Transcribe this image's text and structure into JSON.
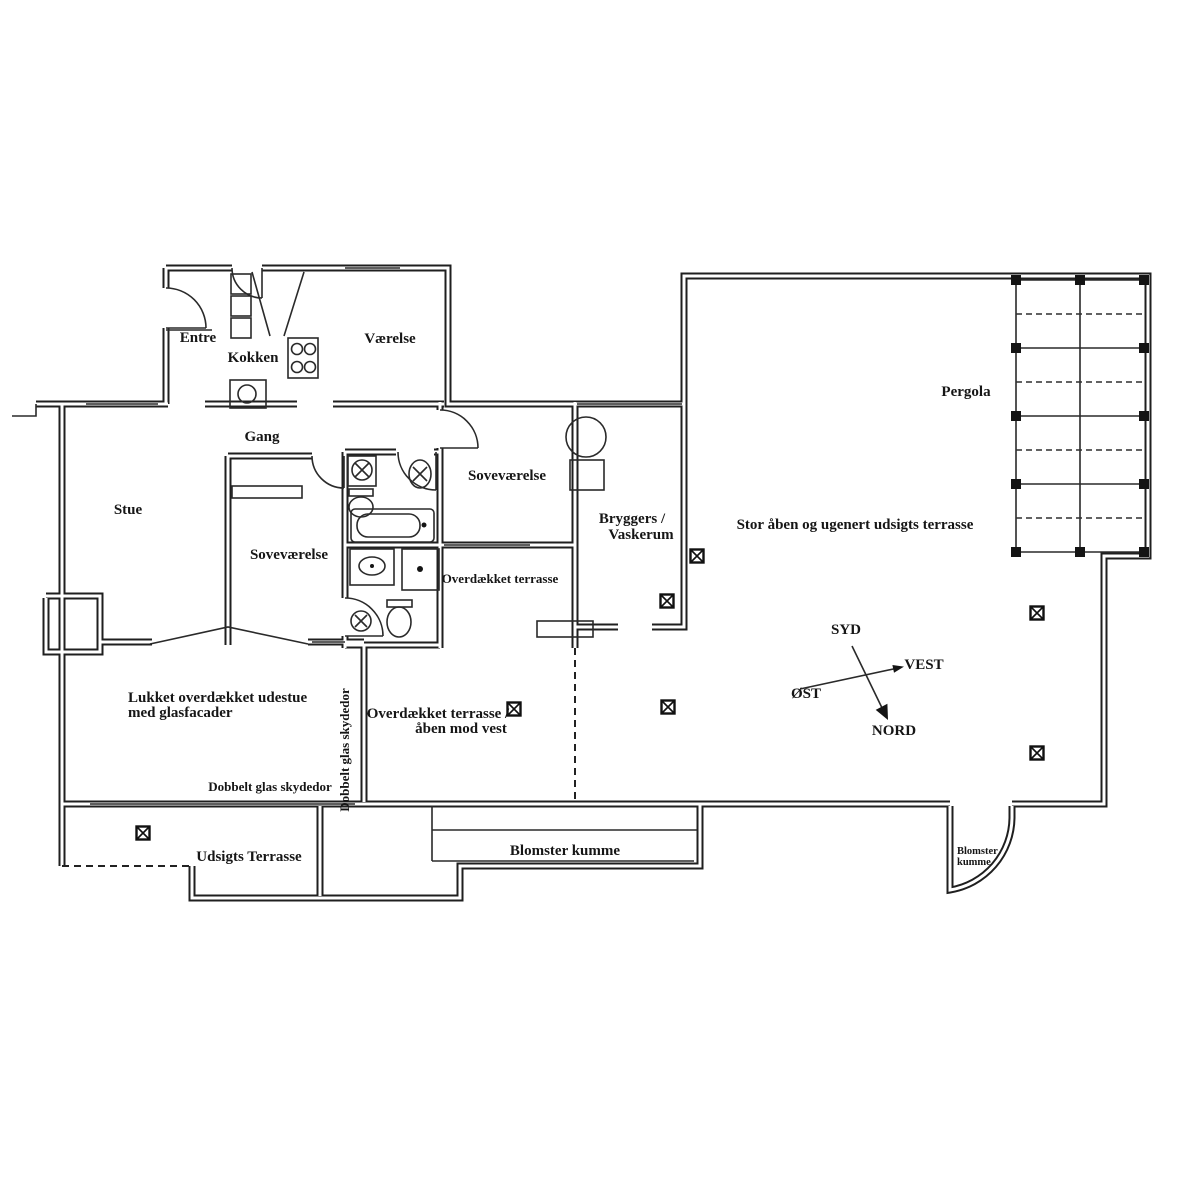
{
  "document": {
    "type": "floor-plan-drawing",
    "background_color": "#ffffff",
    "ink_color": "#1f1f1f"
  },
  "labels": {
    "entre": "Entre",
    "kokken": "Kokken",
    "vaerelse": "Værelse",
    "gang": "Gang",
    "stue": "Stue",
    "sovevaerelse_left": "Soveværelse",
    "sovevaerelse_right": "Soveværelse",
    "bryggers_line1": "Bryggers /",
    "bryggers_line2": "Vaskerum",
    "overdaekket_terrasse": "Overdækket terrasse",
    "stor_terrasse": "Stor åben og ugenert udsigts terrasse",
    "pergola": "Pergola",
    "udestue_line1": "Lukket overdækket udestue",
    "udestue_line2": "med glasfacader",
    "dobbelt_glas_horizontal": "Dobbelt glas skydedor",
    "dobbelt_glas_vertical": "Dobbelt glas skydedor",
    "terrasse_vest_line1": "Overdækket terrasse /",
    "terrasse_vest_line2": "åben mod vest",
    "udsigts_terrasse": "Udsigts Terrasse",
    "blomster_kumme": "Blomster kumme",
    "blomster_kumme_small_line1": "Blomster",
    "blomster_kumme_small_line2": "kumme"
  },
  "compass": {
    "south": "SYD",
    "west": "VEST",
    "east": "ØST",
    "north": "NORD"
  }
}
